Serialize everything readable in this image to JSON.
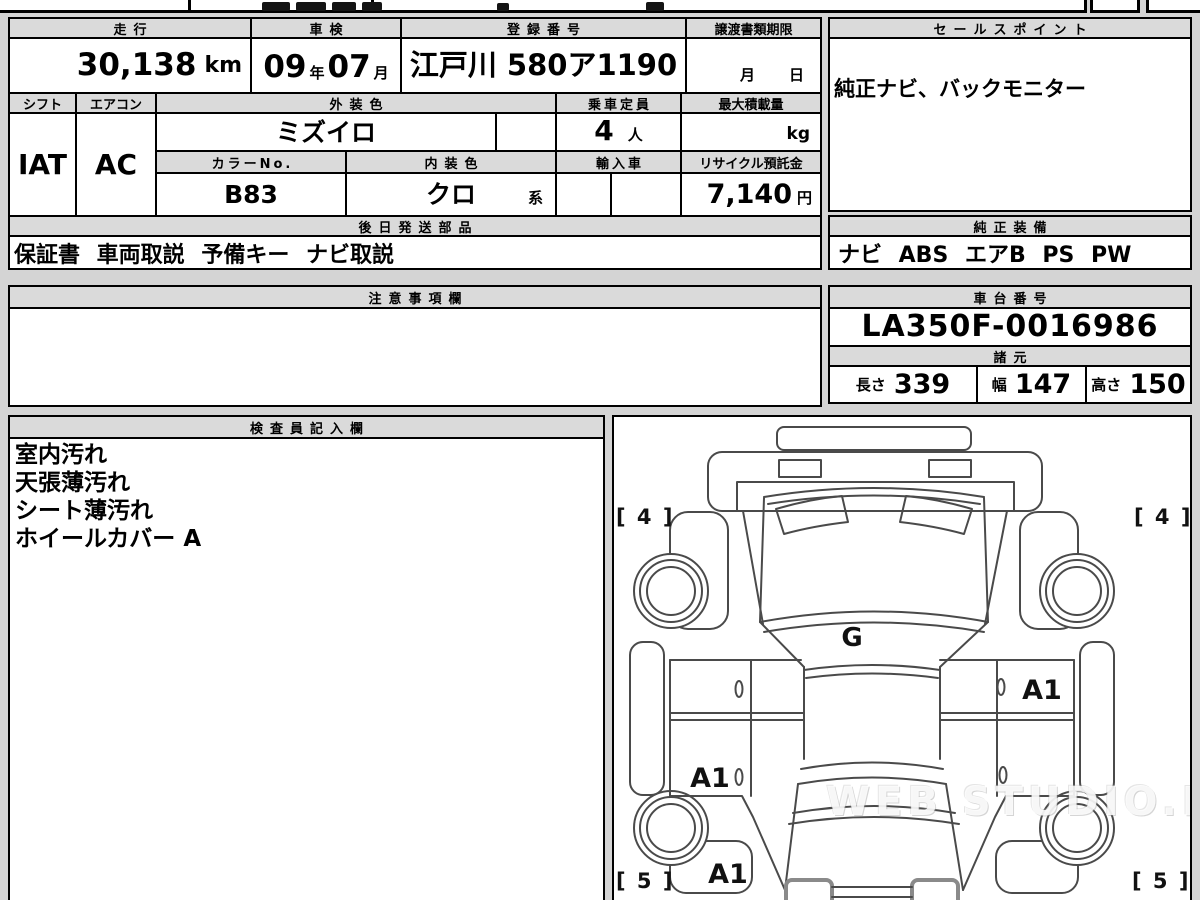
{
  "top_table": {
    "mileage_header": "走行",
    "mileage_value": "30,138",
    "mileage_unit": "km",
    "inspection_header": "車検",
    "inspection_year": "09",
    "inspection_year_unit": "年",
    "inspection_month": "07",
    "inspection_month_unit": "月",
    "registration_header": "登録番号",
    "registration_value": "江戸川 580ア1190",
    "transfer_header": "譲渡書類期限",
    "transfer_month_label": "月",
    "transfer_day_label": "日",
    "shift_header": "シフト",
    "shift_value": "IAT",
    "aircon_header": "エアコン",
    "aircon_value": "AC",
    "exterior_color_header": "外装色",
    "exterior_color_value": "ミズイロ",
    "capacity_header": "乗車定員",
    "capacity_value": "4",
    "capacity_unit": "人",
    "max_load_header": "最大積載量",
    "max_load_unit": "kg",
    "color_no_header": "カラーNo.",
    "color_no_value": "B83",
    "interior_color_header": "内装色",
    "interior_color_value": "クロ",
    "interior_color_suffix": "系",
    "import_header": "輸入車",
    "recycle_header": "リサイクル預託金",
    "recycle_value": "7,140",
    "recycle_unit": "円",
    "later_parts_header": "後日発送部品",
    "later_parts_value": "保証書 車両取説 予備キー ナビ取説"
  },
  "sales_points": {
    "header": "セールスポイント",
    "body": "純正ナビ、バックモニター"
  },
  "genuine_equipment": {
    "header": "純正装備",
    "body": "ナビ ABS エアB PS PW"
  },
  "notes": {
    "header": "注意事項欄",
    "body": ""
  },
  "chassis": {
    "header": "車台番号",
    "value": "LA350F-0016986"
  },
  "specs": {
    "header": "諸元",
    "length_label": "長さ",
    "length_value": "339",
    "width_label": "幅",
    "width_value": "147",
    "height_label": "高さ",
    "height_value": "150"
  },
  "inspector": {
    "header": "検査員記入欄",
    "lines": [
      "室内汚れ",
      "天張薄汚れ",
      "シート薄汚れ",
      "ホイールカバー A"
    ]
  },
  "diagram": {
    "front_left_mark": "[ 4 ]",
    "front_right_mark": "[ 4 ]",
    "rear_left_mark": "[ 5 ]",
    "rear_right_mark": "[ 5 ]",
    "windshield_mark": "G",
    "right_door_mark": "A1",
    "left_door_mark": "A1",
    "rear_panel_mark": "A1",
    "watermark": "WEB STUDIO.PRO"
  }
}
